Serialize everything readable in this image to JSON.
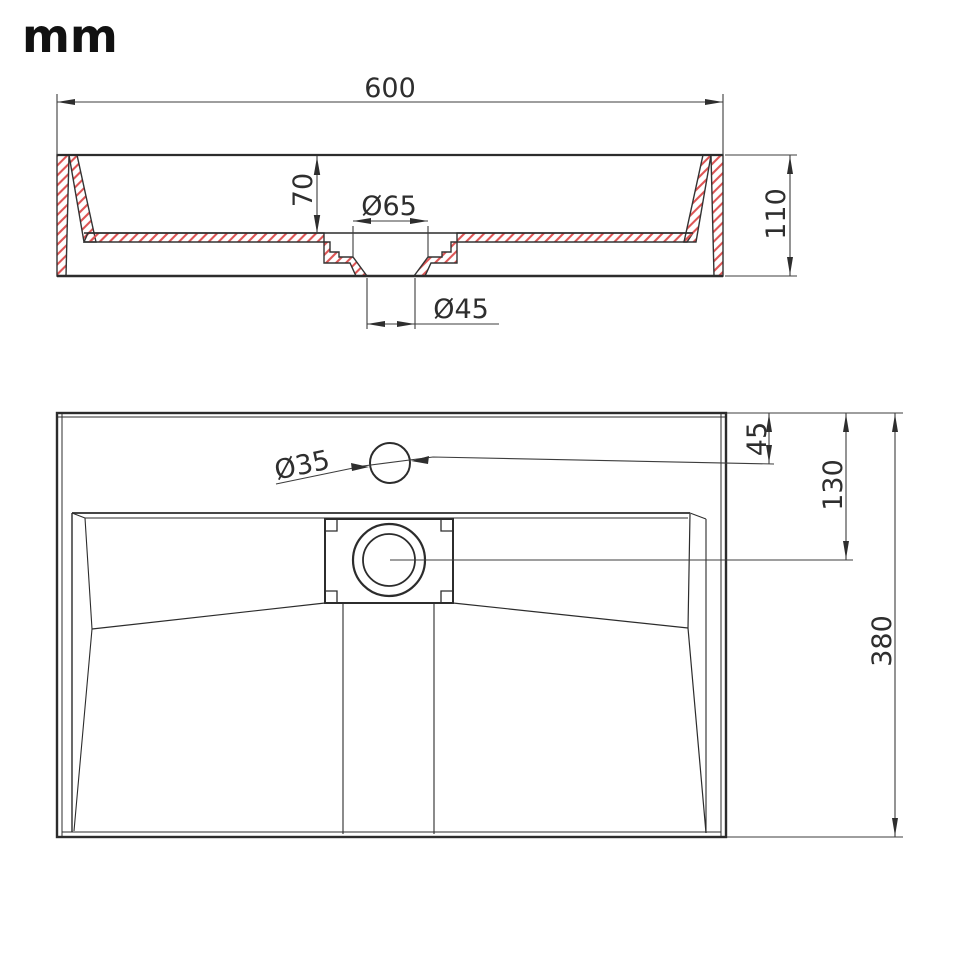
{
  "unit_label": "mm",
  "colors": {
    "line": "#2c2c2c",
    "hatch_red": "#dd5454",
    "dim_line": "#3d3d3d"
  },
  "section_view": {
    "overall_width_label": "600",
    "basin_depth_label": "70",
    "drain_top_diameter_label": "Ø65",
    "overall_height_label": "110",
    "drain_outlet_diameter_label": "Ø45",
    "values": {
      "overall_width_mm": 600,
      "basin_depth_mm": 70,
      "drain_top_diameter_mm": 65,
      "overall_height_mm": 110,
      "drain_outlet_diameter_mm": 45
    }
  },
  "plan_view": {
    "faucet_hole_diameter_label": "Ø35",
    "faucet_center_offset_label": "45",
    "drain_center_offset_label": "130",
    "overall_depth_label": "380",
    "values": {
      "faucet_hole_diameter_mm": 35,
      "faucet_center_offset_mm": 45,
      "drain_center_offset_mm": 130,
      "overall_depth_mm": 380
    }
  }
}
